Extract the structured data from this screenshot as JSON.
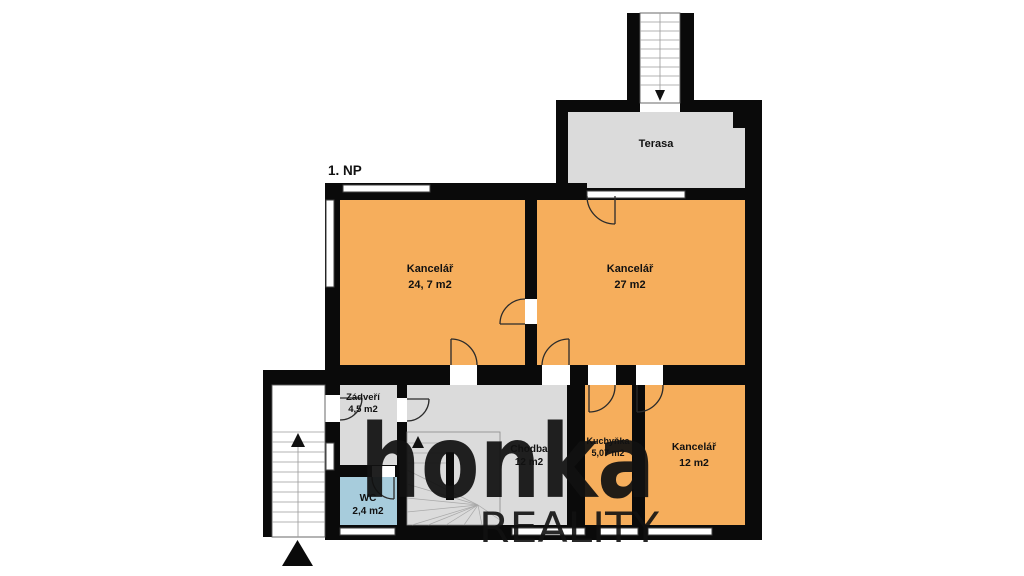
{
  "plan": {
    "floor_label": "1. NP",
    "colors": {
      "office": "#F6AE5C",
      "common": "#DBDBDB",
      "wc": "#A7CCDC",
      "wall": "#0A0A0A",
      "watermark_brand": "#7B6C5E",
      "watermark_sub": "#B5B0AB"
    },
    "rooms": [
      {
        "id": "terasa",
        "name": "Terasa",
        "area": ""
      },
      {
        "id": "office1",
        "name": "Kancelář",
        "area": "24, 7 m2"
      },
      {
        "id": "office2",
        "name": "Kancelář",
        "area": "27 m2"
      },
      {
        "id": "zadveri",
        "name": "Zádveří",
        "area": "4,5 m2"
      },
      {
        "id": "chodba",
        "name": "Chodba",
        "area": "12 m2"
      },
      {
        "id": "wc",
        "name": "WC",
        "area": "2,4 m2"
      },
      {
        "id": "kuchynka",
        "name": "Kuchyňka",
        "area": "5,07 m2"
      },
      {
        "id": "office3",
        "name": "Kancelář",
        "area": "12 m2"
      }
    ],
    "watermark": {
      "brand": "honka",
      "subbrand": "REALITY"
    }
  }
}
